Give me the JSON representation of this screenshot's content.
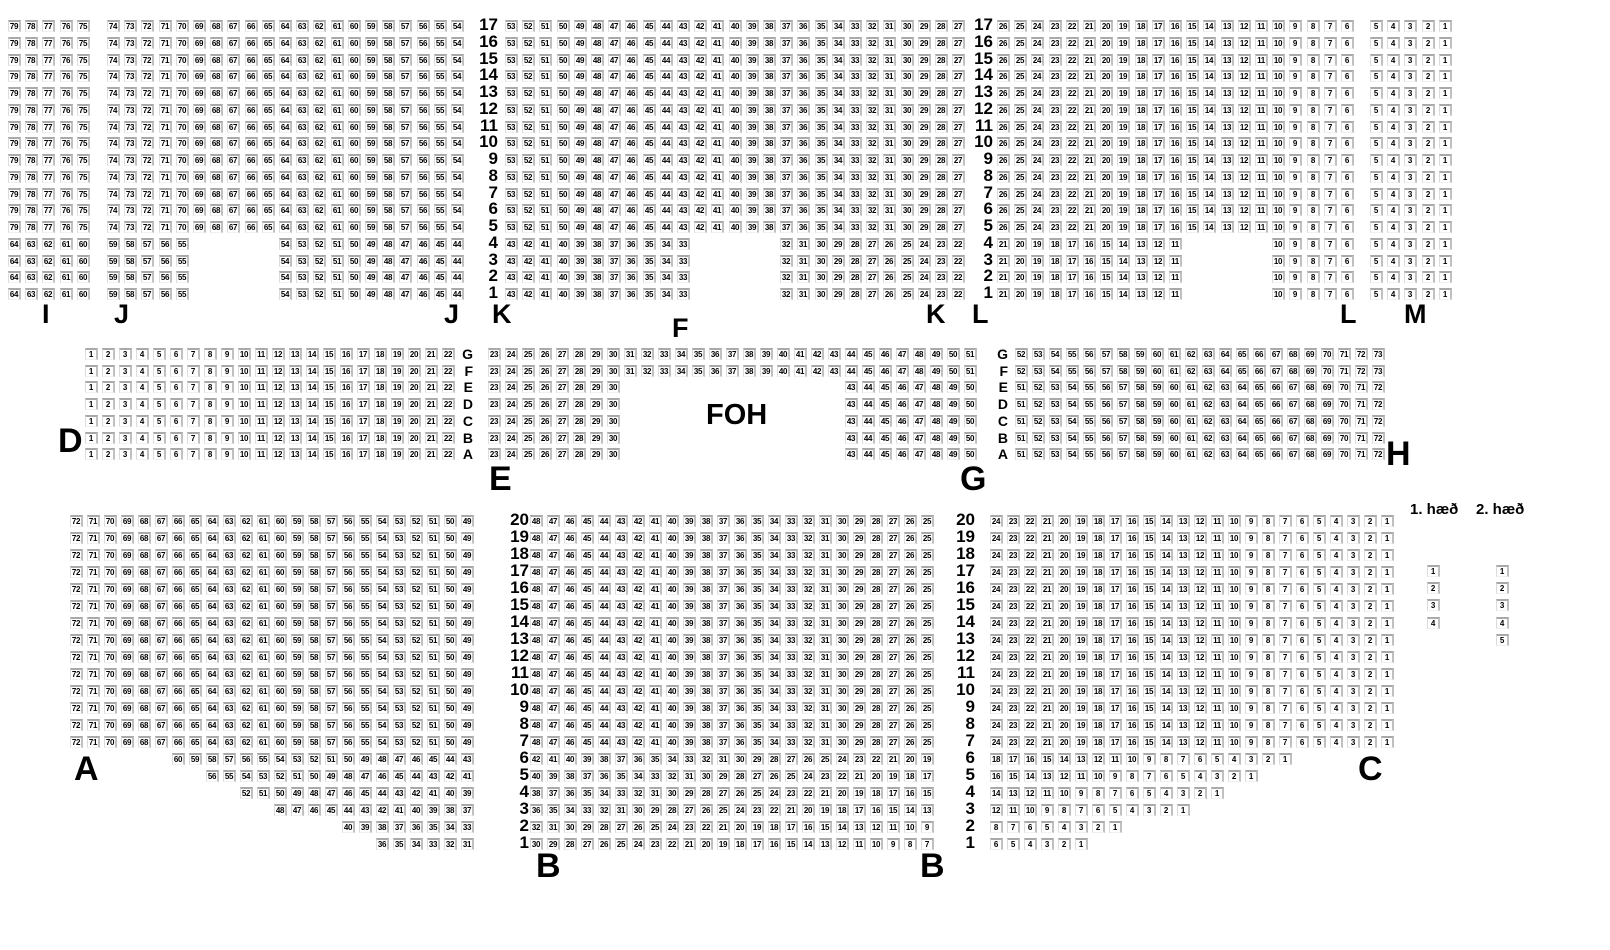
{
  "legend": {
    "floor1": "1. hæð",
    "floor2": "2. hæð"
  },
  "foh_label": "FOH",
  "sections": [
    {
      "id": "I",
      "x": 8,
      "y": 20,
      "px": 17.2,
      "py": 16.75,
      "rows": [
        {
          "n": 13,
          "segs": [
            [
              0,
              79,
              75
            ]
          ]
        },
        {
          "n": 4,
          "segs": [
            [
              0,
              64,
              60
            ]
          ]
        }
      ]
    },
    {
      "id": "J",
      "x": 107,
      "y": 20,
      "px": 17.2,
      "py": 16.75,
      "rows": [
        {
          "n": 13,
          "segs": [
            [
              0,
              74,
              54
            ]
          ]
        },
        {
          "n": 4,
          "segs": [
            [
              0,
              59,
              55
            ],
            [
              10,
              54,
              44
            ]
          ]
        }
      ]
    },
    {
      "id": "K",
      "x": 505,
      "y": 20,
      "px": 17.2,
      "py": 16.75,
      "rows": [
        {
          "n": 13,
          "segs": [
            [
              0,
              53,
              27
            ]
          ]
        },
        {
          "n": 4,
          "segs": [
            [
              0,
              43,
              33
            ],
            [
              16,
              32,
              22
            ]
          ]
        }
      ]
    },
    {
      "id": "L",
      "x": 997,
      "y": 20,
      "px": 17.2,
      "py": 16.75,
      "rows": [
        {
          "n": 13,
          "segs": [
            [
              0,
              26,
              6
            ]
          ]
        },
        {
          "n": 4,
          "segs": [
            [
              0,
              21,
              11
            ],
            [
              16,
              10,
              6
            ]
          ]
        }
      ]
    },
    {
      "id": "M",
      "x": 1370,
      "y": 20,
      "px": 17.2,
      "py": 16.75,
      "rows": [
        {
          "n": 17,
          "segs": [
            [
              0,
              5,
              1
            ]
          ]
        }
      ]
    },
    {
      "id": "D",
      "x": 85,
      "y": 348,
      "px": 17,
      "py": 16.7,
      "rows": [
        {
          "n": 7,
          "segs": [
            [
              0,
              1,
              22
            ]
          ]
        }
      ]
    },
    {
      "id": "E",
      "x": 488,
      "y": 348,
      "px": 17,
      "py": 16.7,
      "rows": [
        {
          "n": 2,
          "segs": [
            [
              0,
              23,
              51
            ]
          ]
        },
        {
          "n": 5,
          "segs": [
            [
              0,
              23,
              30
            ],
            [
              21,
              43,
              50
            ]
          ]
        }
      ]
    },
    {
      "id": "H",
      "x": 1015,
      "y": 348,
      "px": 17,
      "py": 16.7,
      "rows": [
        {
          "n": 2,
          "segs": [
            [
              0,
              52,
              73
            ]
          ]
        },
        {
          "n": 5,
          "segs": [
            [
              0,
              51,
              72
            ]
          ]
        }
      ]
    },
    {
      "id": "A",
      "x": 70,
      "y": 515,
      "px": 17,
      "py": 17,
      "rows": [
        {
          "n": 14,
          "segs": [
            [
              0,
              72,
              49
            ]
          ]
        },
        {
          "n": 1,
          "segs": [
            [
              6,
              60,
              43
            ]
          ]
        },
        {
          "n": 1,
          "segs": [
            [
              8,
              56,
              41
            ]
          ]
        },
        {
          "n": 1,
          "segs": [
            [
              10,
              52,
              39
            ]
          ]
        },
        {
          "n": 1,
          "segs": [
            [
              12,
              48,
              37
            ]
          ]
        },
        {
          "n": 1,
          "segs": [
            [
              16,
              40,
              33
            ]
          ]
        },
        {
          "n": 1,
          "segs": [
            [
              18,
              36,
              31
            ]
          ]
        }
      ]
    },
    {
      "id": "B",
      "x": 530,
      "y": 515,
      "px": 17,
      "py": 17,
      "rows": [
        {
          "n": 14,
          "segs": [
            [
              0,
              48,
              25
            ]
          ]
        },
        {
          "n": 1,
          "segs": [
            [
              0,
              42,
              19
            ]
          ]
        },
        {
          "n": 1,
          "segs": [
            [
              0,
              40,
              17
            ]
          ]
        },
        {
          "n": 1,
          "segs": [
            [
              0,
              38,
              15
            ]
          ]
        },
        {
          "n": 1,
          "segs": [
            [
              0,
              36,
              13
            ]
          ]
        },
        {
          "n": 1,
          "segs": [
            [
              0,
              32,
              9
            ]
          ]
        },
        {
          "n": 1,
          "segs": [
            [
              0,
              30,
              7
            ]
          ]
        }
      ]
    },
    {
      "id": "C",
      "x": 990,
      "y": 515,
      "px": 17,
      "py": 17,
      "rows": [
        {
          "n": 14,
          "segs": [
            [
              0,
              24,
              1
            ]
          ]
        },
        {
          "n": 1,
          "segs": [
            [
              0,
              18,
              1
            ]
          ]
        },
        {
          "n": 1,
          "segs": [
            [
              0,
              16,
              1
            ]
          ]
        },
        {
          "n": 1,
          "segs": [
            [
              0,
              14,
              1
            ]
          ]
        },
        {
          "n": 1,
          "segs": [
            [
              0,
              12,
              1
            ]
          ]
        },
        {
          "n": 1,
          "segs": [
            [
              0,
              8,
              1
            ]
          ]
        },
        {
          "n": 1,
          "segs": [
            [
              0,
              6,
              1
            ]
          ]
        }
      ]
    }
  ],
  "row_label_columns": [
    {
      "x": 476,
      "y": 20,
      "py": 16.75,
      "style": "num",
      "labels": [
        "17",
        "16",
        "15",
        "14",
        "13",
        "12",
        "11",
        "10",
        "9",
        "8",
        "7",
        "6",
        "5",
        "4",
        "3",
        "2",
        "1"
      ]
    },
    {
      "x": 971,
      "y": 20,
      "py": 16.75,
      "style": "num",
      "labels": [
        "17",
        "16",
        "15",
        "14",
        "13",
        "12",
        "11",
        "10",
        "9",
        "8",
        "7",
        "6",
        "5",
        "4",
        "3",
        "2",
        "1"
      ]
    },
    {
      "x": 459,
      "y": 348,
      "py": 16.7,
      "style": "alpha",
      "labels": [
        "G",
        "F",
        "E",
        "D",
        "C",
        "B",
        "A"
      ]
    },
    {
      "x": 994,
      "y": 348,
      "py": 16.7,
      "style": "alpha",
      "labels": [
        "G",
        "F",
        "E",
        "D",
        "C",
        "B",
        "A"
      ]
    },
    {
      "x": 507,
      "y": 515,
      "py": 17,
      "style": "num",
      "labels": [
        "20",
        "19",
        "18",
        "17",
        "16",
        "15",
        "14",
        "13",
        "12",
        "11",
        "10",
        "9",
        "8",
        "7",
        "6",
        "5",
        "4",
        "3",
        "2",
        "1"
      ]
    },
    {
      "x": 953,
      "y": 515,
      "py": 17,
      "style": "num",
      "labels": [
        "20",
        "19",
        "18",
        "17",
        "16",
        "15",
        "14",
        "13",
        "12",
        "11",
        "10",
        "9",
        "8",
        "7",
        "6",
        "5",
        "4",
        "3",
        "2",
        "1"
      ]
    }
  ],
  "section_labels": [
    {
      "text": "I",
      "x": 42,
      "y": 301,
      "size": 27
    },
    {
      "text": "J",
      "x": 114,
      "y": 301,
      "size": 27
    },
    {
      "text": "J",
      "x": 444,
      "y": 301,
      "size": 27
    },
    {
      "text": "K",
      "x": 492,
      "y": 301,
      "size": 27
    },
    {
      "text": "F",
      "x": 672,
      "y": 315,
      "size": 27
    },
    {
      "text": "K",
      "x": 926,
      "y": 301,
      "size": 27
    },
    {
      "text": "L",
      "x": 972,
      "y": 301,
      "size": 27
    },
    {
      "text": "L",
      "x": 1340,
      "y": 301,
      "size": 27
    },
    {
      "text": "M",
      "x": 1404,
      "y": 301,
      "size": 27
    },
    {
      "text": "D",
      "x": 58,
      "y": 424,
      "size": 34
    },
    {
      "text": "E",
      "x": 489,
      "y": 462,
      "size": 34
    },
    {
      "text": "G",
      "x": 960,
      "y": 462,
      "size": 34
    },
    {
      "text": "H",
      "x": 1386,
      "y": 437,
      "size": 34
    },
    {
      "text": "FOH",
      "x": 706,
      "y": 401,
      "size": 29
    },
    {
      "text": "A",
      "x": 74,
      "y": 752,
      "size": 34
    },
    {
      "text": "B",
      "x": 536,
      "y": 849,
      "size": 34
    },
    {
      "text": "B",
      "x": 920,
      "y": 849,
      "size": 34
    },
    {
      "text": "C",
      "x": 1358,
      "y": 752,
      "size": 34
    }
  ],
  "accessible_columns": [
    {
      "name": "floor-1-seats",
      "x": 1427,
      "y": 565,
      "py": 17.2,
      "values": [
        "1",
        "2",
        "3",
        "4"
      ]
    },
    {
      "name": "floor-2-seats",
      "x": 1496,
      "y": 565,
      "py": 17.2,
      "values": [
        "1",
        "2",
        "3",
        "4",
        "5"
      ]
    }
  ]
}
